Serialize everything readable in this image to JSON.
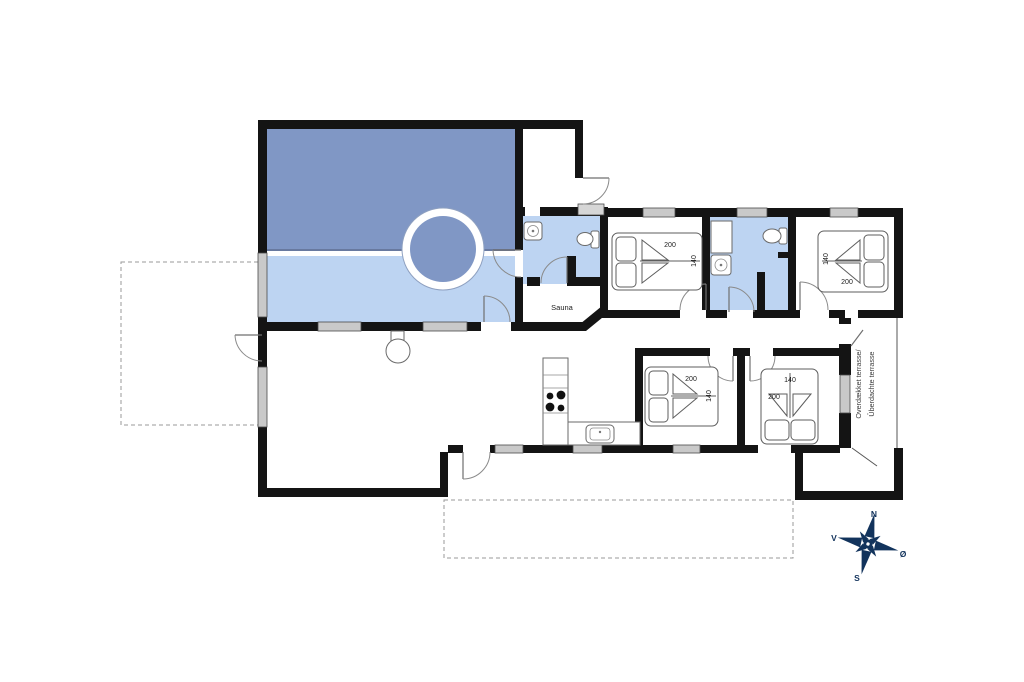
{
  "colors": {
    "wall": "#141414",
    "pool": "#8097c5",
    "wetfloor": "#bdd4f2",
    "windowfill": "#c9c9c9",
    "compass": "#12335c"
  },
  "labels": {
    "sauna": "Sauna",
    "covered_terrace_line1": "Overdækket terrasse/",
    "covered_terrace_line2": "Überdachte terrasse"
  },
  "compass": {
    "north": "N",
    "south": "S",
    "west": "V",
    "east": "Ø"
  },
  "beds": {
    "bedroom1": {
      "length": "200",
      "width": "140"
    },
    "bedroom2": {
      "length": "200",
      "width": "140"
    },
    "bedroom3": {
      "length": "200",
      "width": "140"
    },
    "bedroom4": {
      "length": "200",
      "width": "140"
    }
  }
}
